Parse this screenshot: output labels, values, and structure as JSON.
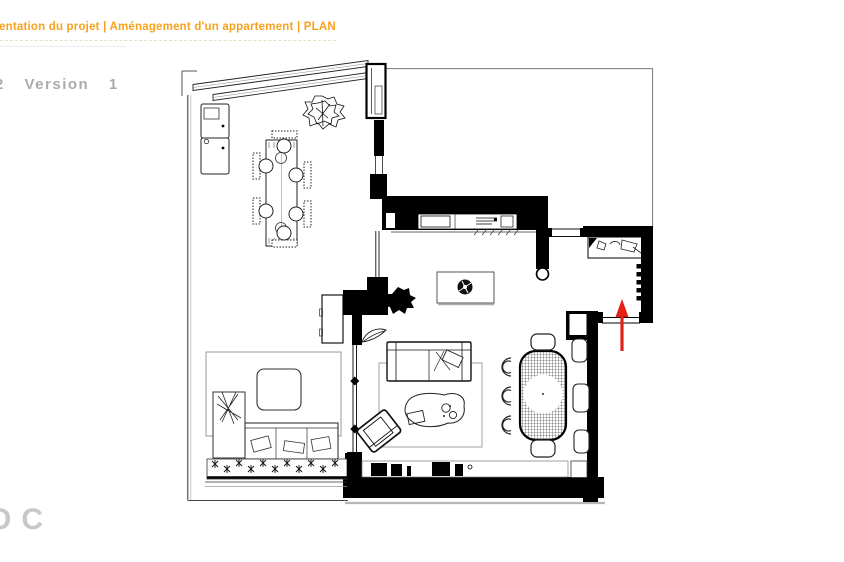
{
  "slide": {
    "title": "entation du projet | Aménagement d'un appartement | PLAN",
    "version_label": "2 Version 1",
    "footer_logo": "OC",
    "colors": {
      "title_orange": "#F6A21D",
      "version_gray": "#ABABAB",
      "footer_gray": "#C8C8C8",
      "arrow_red": "#E32119",
      "wall_black": "#000000",
      "boundary_gray": "#8A8A8A"
    }
  }
}
